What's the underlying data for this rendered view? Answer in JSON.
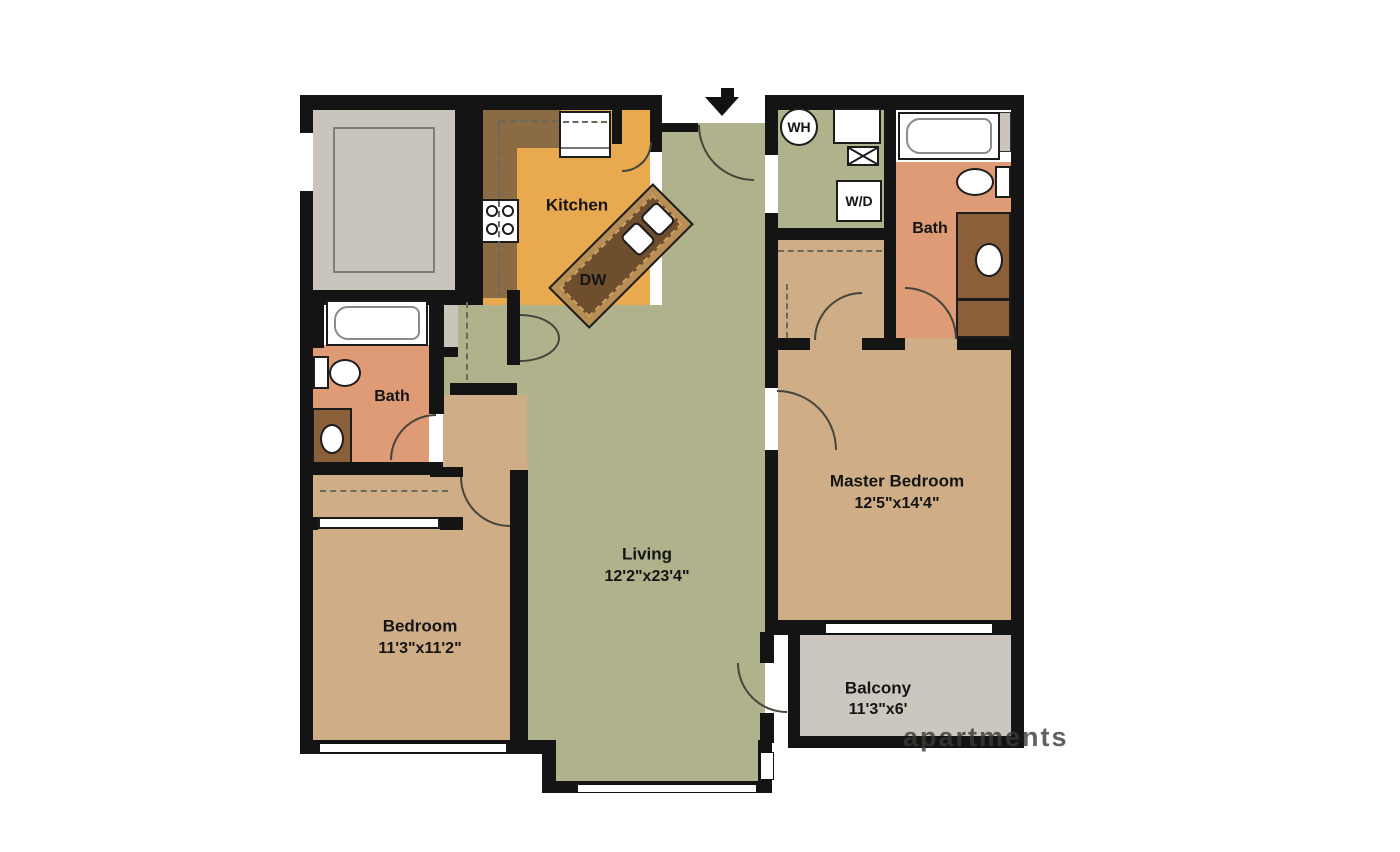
{
  "plan": {
    "rooms": {
      "kitchen": {
        "label": "Kitchen"
      },
      "living": {
        "label": "Living",
        "dimensions": "12'2\"x23'4\""
      },
      "master_bedroom": {
        "label": "Master Bedroom",
        "dimensions": "12'5\"x14'4\""
      },
      "bedroom": {
        "label": "Bedroom",
        "dimensions": "11'3\"x11'2\""
      },
      "balcony": {
        "label": "Balcony",
        "dimensions": "11'3\"x6'"
      },
      "bath_main": {
        "label": "Bath"
      },
      "bath_master": {
        "label": "Bath"
      }
    },
    "appliances": {
      "dishwasher": "DW",
      "water_heater": "WH",
      "washer_dryer": "W/D"
    },
    "watermark": "apartments"
  },
  "colors": {
    "wall": "#141414",
    "green": "#afb28b",
    "orange": "#e9a94f",
    "counter": "#8a6b44",
    "island_frame": "#b98e55",
    "island_dark": "#6f4e2d",
    "salmon": "#de9b76",
    "vanity": "#8a5f3a",
    "tan": "#cfae87",
    "balcony": "#cbc7bf",
    "storage": "#c9c5bd",
    "line": "#46453c",
    "dash": "#6b695c"
  }
}
